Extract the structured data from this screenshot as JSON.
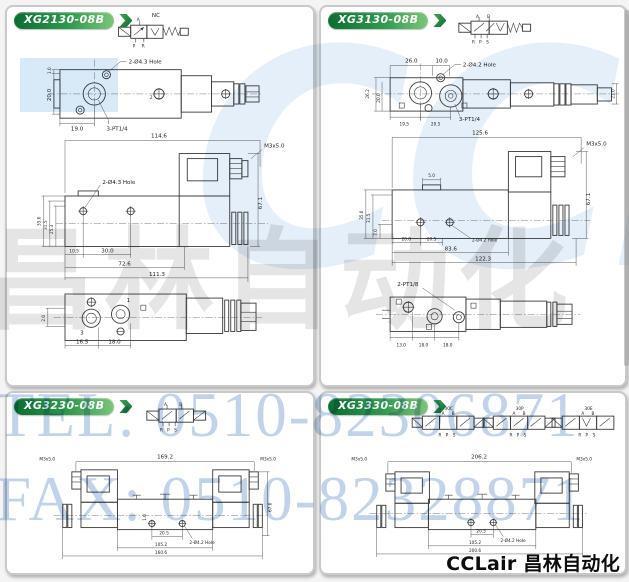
{
  "page": {
    "accent_green": "#0a6e31",
    "watermark_blue": "#b5cbe7"
  },
  "watermarks": {
    "logo": "CCLair",
    "cn": "昌林自动化",
    "tel": "TEL: 0510-82306871",
    "fax": "FAX: 0510-82328871"
  },
  "footer": {
    "brand": "CCLair 昌林自动化"
  },
  "panels": [
    {
      "title": "XG2130-08B",
      "dims": {
        "sym_nc": "NC",
        "sym_a": "A",
        "sym_p": "P",
        "sym_r": "R",
        "tv_hole": "2-Ø4.3 Hole",
        "tv_port3": "3-PT1/4",
        "tv_h2": "1.0",
        "tv_h": "20.0",
        "tv_w": "19.0",
        "tv_p2": "2",
        "sv_w": "114.6",
        "sv_m": "M3x5.0",
        "sv_h": "67.1",
        "sv_l1": "35.0",
        "sv_l2": "31.5",
        "sv_l3": "25.3",
        "sv_hole": "2-Ø4.3 Hole",
        "sv_b1": "10.5",
        "sv_b2": "30.0",
        "sv_b3": "72.6",
        "sv_b4": "111.3",
        "bv_l": "2.0",
        "bv_b1": "16.5",
        "bv_b2": "18.0",
        "bv_p3": "3",
        "bv_p1": "1"
      }
    },
    {
      "title": "XG3130-08B",
      "dims": {
        "sym_a": "A",
        "sym_b": "B",
        "sym_r": "R",
        "sym_p": "P",
        "sym_s": "S",
        "tv_t1": "26.0",
        "tv_t2": "10.0",
        "tv_hole": "2-Ø4.2 Hole",
        "tv_port3": "3-PT1/4",
        "tv_l1": "26.2",
        "tv_l2": "20.0",
        "tv_r": "21.0",
        "tv_b1": "19.5",
        "tv_b2": "20.5",
        "sv_w": "125.6",
        "sv_m": "M3x5.0",
        "sv_t": "5.0",
        "sv_h": "67.1",
        "sv_l1": "35.0",
        "sv_l2": "31.5",
        "sv_l3": "7.0",
        "sv_b1": "20.8",
        "sv_b2": "20.5",
        "sv_hole": "2-Ø4.2 Hole",
        "sv_b3": "83.6",
        "sv_b4": "122.3",
        "bv_port": "2-PT1/8",
        "bv_b1": "13.0",
        "bv_b2": "18.0",
        "bv_b3": "18.0"
      }
    },
    {
      "title": "XG3230-08B",
      "dims": {
        "sym_a": "A",
        "sym_b": "B",
        "sym_r": "R",
        "sym_p": "P",
        "sym_s": "S",
        "m_left": "M3x5.0",
        "w": "169.2",
        "m_right": "M3x5.0",
        "h": "67.0",
        "small": "1.0",
        "b1": "20.5",
        "hole": "2-Ø4.2 Hole",
        "b2": "105.2",
        "b3": "160.6"
      }
    },
    {
      "title": "XG3330-08B",
      "dims": {
        "sym1": "30C",
        "sym2": "30P",
        "sym3": "30E",
        "sym_a": "A",
        "sym_b": "B",
        "sym_r": "R",
        "sym_p": "P",
        "sym_s": "S",
        "m_left": "M3x5.0",
        "w": "206.2",
        "m_right": "M3x5.0",
        "b1": "20.5",
        "hole": "2-Ø4.2 Hole",
        "b2": "105.2",
        "b3": "200.6"
      }
    }
  ]
}
